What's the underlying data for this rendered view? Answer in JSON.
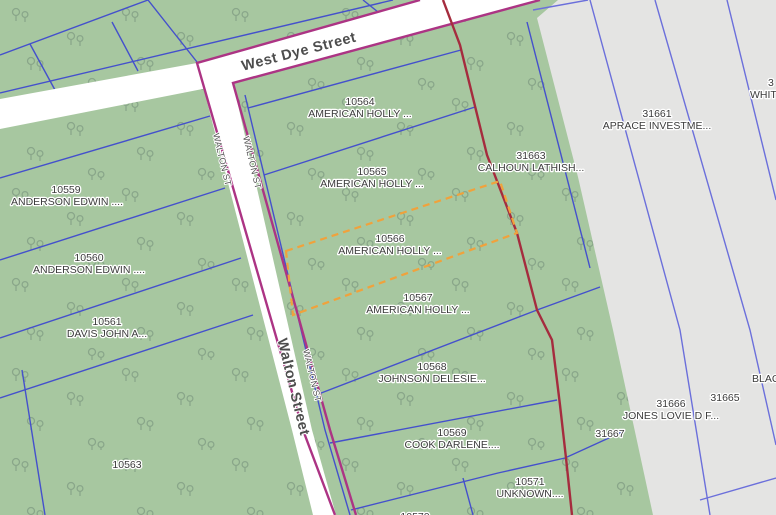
{
  "map": {
    "streets": {
      "west_dye_label": "West Dye Street",
      "walton_label": "Walton Street",
      "walton_abbrev_1": "WALTON ST",
      "walton_abbrev_2": "WALTON ST",
      "walton_abbrev_3": "WALTON ST"
    },
    "parcels": [
      {
        "id": "10559",
        "owner": "ANDERSON EDWIN ...."
      },
      {
        "id": "10560",
        "owner": "ANDERSON EDWIN ...."
      },
      {
        "id": "10561",
        "owner": "DAVIS JOHN A..."
      },
      {
        "id": "10563",
        "owner": ""
      },
      {
        "id": "10564",
        "owner": "AMERICAN HOLLY ..."
      },
      {
        "id": "10565",
        "owner": "AMERICAN HOLLY ..."
      },
      {
        "id": "10566",
        "owner": "AMERICAN HOLLY ...",
        "selected": true
      },
      {
        "id": "10567",
        "owner": "AMERICAN HOLLY ..."
      },
      {
        "id": "10568",
        "owner": "JOHNSON DELESIE..."
      },
      {
        "id": "10569",
        "owner": "COOK DARLENE...."
      },
      {
        "id": "10571",
        "owner": "UNKNOWN...."
      },
      {
        "id": "10570",
        "owner": ""
      },
      {
        "id": "31663",
        "owner": "CALHOUN LATHISH..."
      },
      {
        "id": "31661",
        "owner": "APRACE INVESTME..."
      },
      {
        "id": "31665",
        "owner": ""
      },
      {
        "id": "31666",
        "owner": "JONES LOVIE D F..."
      },
      {
        "id": "31667",
        "owner": ""
      },
      {
        "id": "3",
        "owner": "WHITT"
      },
      {
        "id": "",
        "owner": "BLAC"
      }
    ],
    "colors": {
      "land_green": "#a7c7a0",
      "parcel_gray": "#e4e4e3",
      "parcel_line_blue": "#4450cc",
      "gray_area_line_blue": "#6b6fdb",
      "street_boundary_magenta": "#ac3484",
      "district_boundary_red": "#a52c3e",
      "selected_parcel_orange": "#f0a23c",
      "street_white": "#ffffff",
      "label_gray": "#3b3b3b",
      "tree_symbol": "#7f9b82"
    }
  }
}
